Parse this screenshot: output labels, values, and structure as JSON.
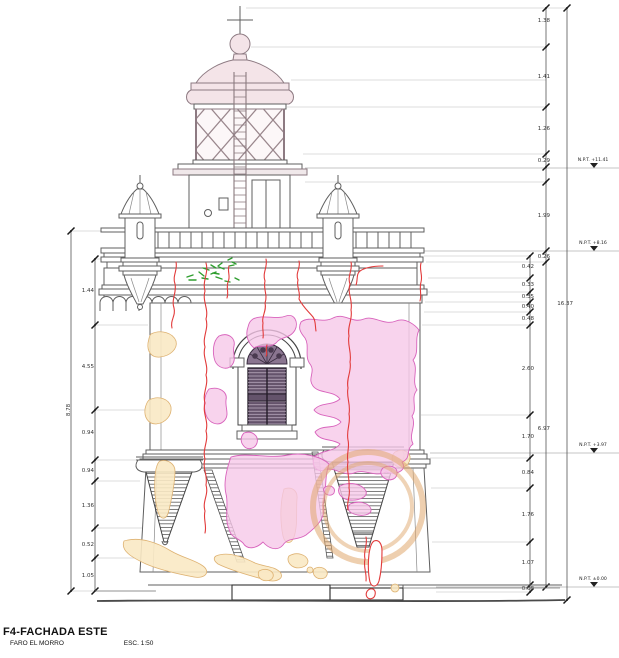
{
  "title_block": {
    "title": "F4-FACHADA ESTE",
    "project": "FARO EL MORRO",
    "scale": "ESC. 1:50"
  },
  "levels": [
    {
      "label": "N.P.T. +11.41",
      "y": 168,
      "x1": 305
    },
    {
      "label": "N.P.T. +8.16",
      "y": 251,
      "x1": 424
    },
    {
      "label": "N.P.T. +3.97",
      "y": 453,
      "x1": 430
    },
    {
      "label": "N.P.T. ±0.00",
      "y": 587,
      "x1": 436
    }
  ],
  "dim_chains": [
    {
      "name": "right-outer",
      "x": 567,
      "vertical": false,
      "ldx": 6,
      "ticks": [
        8,
        600
      ],
      "labels": [
        {
          "y": 303,
          "v": "16.37"
        }
      ]
    },
    {
      "name": "right-middle",
      "x": 546,
      "vertical": false,
      "ldx": 4,
      "ticks": [
        8,
        47,
        107,
        154,
        167,
        182,
        251,
        262,
        587
      ],
      "labels": [
        {
          "y": 20,
          "v": "1.38"
        },
        {
          "y": 76,
          "v": "1.41"
        },
        {
          "y": 128,
          "v": "1.26"
        },
        {
          "y": 160,
          "v": "0.29"
        },
        {
          "y": 215,
          "v": "1.99"
        },
        {
          "y": 256,
          "v": "0.26"
        },
        {
          "y": 428,
          "v": "6.97"
        }
      ]
    },
    {
      "name": "right-inner",
      "x": 530,
      "vertical": false,
      "ldx": 4,
      "ticks": [
        256,
        278,
        292,
        302,
        312,
        325,
        415,
        458,
        488,
        542,
        585,
        592
      ],
      "labels": [
        {
          "y": 266,
          "v": "0.42"
        },
        {
          "y": 284,
          "v": "0.33"
        },
        {
          "y": 296,
          "v": "0.35"
        },
        {
          "y": 306,
          "v": "0.40"
        },
        {
          "y": 318,
          "v": "0.48"
        },
        {
          "y": 368,
          "v": "2.60"
        },
        {
          "y": 436,
          "v": "1.70"
        },
        {
          "y": 472,
          "v": "0.84"
        },
        {
          "y": 514,
          "v": "1.76"
        },
        {
          "y": 562,
          "v": "1.07"
        },
        {
          "y": 588,
          "v": "0.08"
        }
      ]
    },
    {
      "name": "left-outer",
      "x": 71,
      "vertical": true,
      "ldx": -3,
      "ticks": [
        231,
        591
      ],
      "labels": [
        {
          "y": 410,
          "v": "8.78"
        }
      ]
    },
    {
      "name": "left-inner",
      "x": 95,
      "vertical": false,
      "ldx": -1,
      "ticks": [
        259,
        325,
        410,
        460,
        481,
        528,
        558,
        591
      ],
      "labels": [
        {
          "y": 290,
          "v": "1.44"
        },
        {
          "y": 366,
          "v": "4.55"
        },
        {
          "y": 432,
          "v": "0.94"
        },
        {
          "y": 470,
          "v": "0.94"
        },
        {
          "y": 505,
          "v": "1.36"
        },
        {
          "y": 544,
          "v": "0.52"
        },
        {
          "y": 575,
          "v": "1.05"
        }
      ]
    }
  ],
  "extension_lines": [
    {
      "y": 8,
      "x1": 246,
      "x2": 567
    },
    {
      "y": 47,
      "x1": 251,
      "x2": 546
    },
    {
      "y": 80,
      "x1": 291,
      "x2": 546
    },
    {
      "y": 107,
      "x1": 287,
      "x2": 546
    },
    {
      "y": 154,
      "x1": 303,
      "x2": 546
    },
    {
      "y": 182,
      "x1": 305,
      "x2": 546
    },
    {
      "y": 231,
      "x1": 148,
      "x2": 71
    },
    {
      "y": 256,
      "x1": 424,
      "x2": 530
    },
    {
      "y": 259,
      "x1": 141,
      "x2": 95
    },
    {
      "y": 262,
      "x1": 426,
      "x2": 546
    },
    {
      "y": 278,
      "x1": 428,
      "x2": 530
    },
    {
      "y": 292,
      "x1": 428,
      "x2": 530
    },
    {
      "y": 302,
      "x1": 425,
      "x2": 530
    },
    {
      "y": 312,
      "x1": 424,
      "x2": 530
    },
    {
      "y": 325,
      "x1": 422,
      "x2": 530
    },
    {
      "y": 325,
      "x1": 148,
      "x2": 95
    },
    {
      "y": 410,
      "x1": 147,
      "x2": 95
    },
    {
      "y": 415,
      "x1": 421,
      "x2": 530
    },
    {
      "y": 458,
      "x1": 430,
      "x2": 530
    },
    {
      "y": 460,
      "x1": 139,
      "x2": 95
    },
    {
      "y": 481,
      "x1": 140,
      "x2": 95
    },
    {
      "y": 488,
      "x1": 431,
      "x2": 530
    },
    {
      "y": 528,
      "x1": 142,
      "x2": 95
    },
    {
      "y": 542,
      "x1": 432,
      "x2": 530
    },
    {
      "y": 558,
      "x1": 143,
      "x2": 95
    },
    {
      "y": 585,
      "x1": 434,
      "x2": 530
    },
    {
      "y": 591,
      "x1": 155,
      "x2": 71
    },
    {
      "y": 592,
      "x1": 436,
      "x2": 530
    },
    {
      "y": 600,
      "x1": 560,
      "x2": 567
    }
  ],
  "colors": {
    "line_work": "#5f5f5f",
    "lantern_pink": "#f4e4e8",
    "damage_patch_pink": "#f6c6e6",
    "damage_patch_outline": "#d863bc",
    "damage_patch_tan": "#f8e6c2",
    "crack_red": "#e23b3b",
    "vegetation_green": "#2f9e2f",
    "stain_ring_orange": "#e2aa6e",
    "shutter_dark": "#64536b"
  }
}
